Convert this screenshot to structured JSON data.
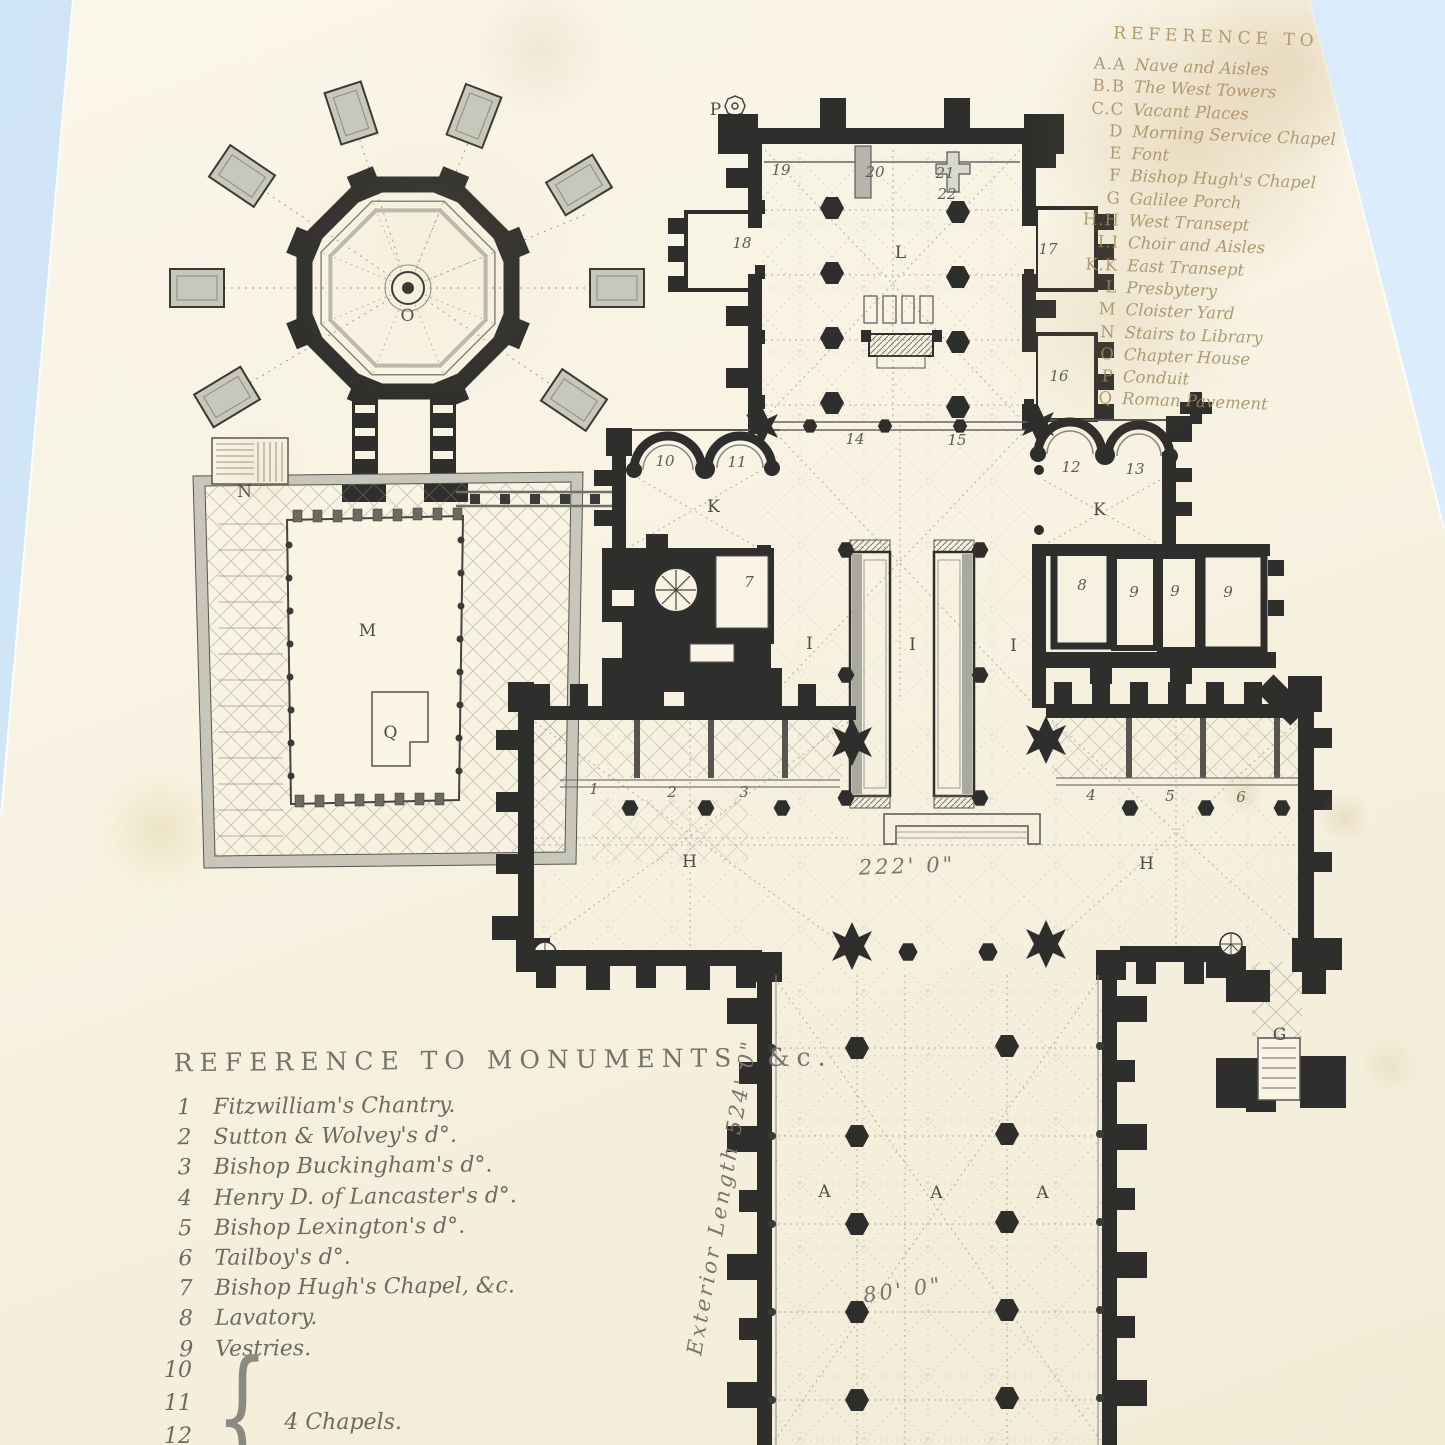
{
  "colors": {
    "background": "#d6e8f7",
    "page": "#f7f2e1",
    "ink": "#2e2e2c",
    "faded_ink": "#a18a63",
    "list_ink": "#6b6b62"
  },
  "plan_reference": {
    "title": "REFERENCE TO PLAN",
    "entries": [
      {
        "key": "A.A",
        "label": "Nave and Aisles"
      },
      {
        "key": "B.B",
        "label": "The West Towers"
      },
      {
        "key": "C.C",
        "label": "Vacant Places"
      },
      {
        "key": "D",
        "label": "Morning Service Chapel"
      },
      {
        "key": "E",
        "label": "Font"
      },
      {
        "key": "F",
        "label": "Bishop Hugh's Chapel"
      },
      {
        "key": "G",
        "label": "Galilee Porch"
      },
      {
        "key": "H.H",
        "label": "West Transept"
      },
      {
        "key": "I.I",
        "label": "Choir and Aisles"
      },
      {
        "key": "K.K",
        "label": "East Transept"
      },
      {
        "key": "L",
        "label": "Presbytery"
      },
      {
        "key": "M",
        "label": "Cloister Yard"
      },
      {
        "key": "N",
        "label": "Stairs to Library"
      },
      {
        "key": "O",
        "label": "Chapter House"
      },
      {
        "key": "P",
        "label": "Conduit"
      },
      {
        "key": "Q",
        "label": "Roman Pavement"
      }
    ]
  },
  "monuments_reference": {
    "title": "REFERENCE TO MONUMENTS, &c.",
    "entries": [
      {
        "num": "1",
        "label": "Fitzwilliam's Chantry."
      },
      {
        "num": "2",
        "label": "Sutton & Wolvey's d°."
      },
      {
        "num": "3",
        "label": "Bishop Buckingham's d°."
      },
      {
        "num": "4",
        "label": "Henry D. of Lancaster's d°."
      },
      {
        "num": "5",
        "label": "Bishop Lexington's d°."
      },
      {
        "num": "6",
        "label": "Tailboy's d°."
      },
      {
        "num": "7",
        "label": "Bishop Hugh's Chapel, &c."
      },
      {
        "num": "8",
        "label": "Lavatory."
      },
      {
        "num": "9",
        "label": "Vestries."
      }
    ],
    "group": {
      "nums": [
        "10",
        "11",
        "12"
      ],
      "brace_glyph": "{",
      "label": "4 Chapels."
    }
  },
  "plan_labels": [
    {
      "text": "O",
      "x": 408,
      "y": 316,
      "kind": "letter"
    },
    {
      "text": "N",
      "x": 245,
      "y": 492,
      "kind": "letter"
    },
    {
      "text": "M",
      "x": 368,
      "y": 631,
      "kind": "letter"
    },
    {
      "text": "Q",
      "x": 391,
      "y": 733,
      "kind": "letter"
    },
    {
      "text": "L",
      "x": 901,
      "y": 253,
      "kind": "letter"
    },
    {
      "text": "K",
      "x": 714,
      "y": 507,
      "kind": "letter"
    },
    {
      "text": "K",
      "x": 1100,
      "y": 510,
      "kind": "letter"
    },
    {
      "text": "I",
      "x": 810,
      "y": 644,
      "kind": "letter"
    },
    {
      "text": "I",
      "x": 913,
      "y": 645,
      "kind": "letter"
    },
    {
      "text": "I",
      "x": 1014,
      "y": 646,
      "kind": "letter"
    },
    {
      "text": "H",
      "x": 690,
      "y": 862,
      "kind": "letter"
    },
    {
      "text": "H",
      "x": 1147,
      "y": 864,
      "kind": "letter"
    },
    {
      "text": "A",
      "x": 825,
      "y": 1192,
      "kind": "letter"
    },
    {
      "text": "A",
      "x": 937,
      "y": 1193,
      "kind": "letter"
    },
    {
      "text": "A",
      "x": 1043,
      "y": 1193,
      "kind": "letter"
    },
    {
      "text": "G",
      "x": 1280,
      "y": 1035,
      "kind": "letter"
    },
    {
      "text": "P",
      "x": 716,
      "y": 110,
      "kind": "letter"
    },
    {
      "text": "1",
      "x": 594,
      "y": 789,
      "kind": "number"
    },
    {
      "text": "2",
      "x": 672,
      "y": 792,
      "kind": "number"
    },
    {
      "text": "3",
      "x": 744,
      "y": 792,
      "kind": "number"
    },
    {
      "text": "4",
      "x": 1091,
      "y": 795,
      "kind": "number"
    },
    {
      "text": "5",
      "x": 1170,
      "y": 796,
      "kind": "number"
    },
    {
      "text": "6",
      "x": 1241,
      "y": 797,
      "kind": "number"
    },
    {
      "text": "7",
      "x": 749,
      "y": 582,
      "kind": "number"
    },
    {
      "text": "8",
      "x": 1082,
      "y": 585,
      "kind": "number"
    },
    {
      "text": "9",
      "x": 1134,
      "y": 592,
      "kind": "number"
    },
    {
      "text": "9",
      "x": 1175,
      "y": 591,
      "kind": "number"
    },
    {
      "text": "9",
      "x": 1228,
      "y": 592,
      "kind": "number"
    },
    {
      "text": "10",
      "x": 665,
      "y": 461,
      "kind": "number"
    },
    {
      "text": "11",
      "x": 737,
      "y": 462,
      "kind": "number"
    },
    {
      "text": "12",
      "x": 1071,
      "y": 467,
      "kind": "number"
    },
    {
      "text": "13",
      "x": 1135,
      "y": 469,
      "kind": "number"
    },
    {
      "text": "14",
      "x": 855,
      "y": 439,
      "kind": "number"
    },
    {
      "text": "15",
      "x": 957,
      "y": 440,
      "kind": "number"
    },
    {
      "text": "16",
      "x": 1059,
      "y": 376,
      "kind": "number"
    },
    {
      "text": "17",
      "x": 1048,
      "y": 249,
      "kind": "number"
    },
    {
      "text": "18",
      "x": 742,
      "y": 243,
      "kind": "number"
    },
    {
      "text": "19",
      "x": 781,
      "y": 170,
      "kind": "number"
    },
    {
      "text": "20",
      "x": 875,
      "y": 172,
      "kind": "number"
    },
    {
      "text": "21",
      "x": 945,
      "y": 173,
      "kind": "number"
    },
    {
      "text": "22",
      "x": 947,
      "y": 194,
      "kind": "number"
    },
    {
      "text": "222' 0\"",
      "x": 907,
      "y": 866,
      "kind": "dim",
      "rotate": -2
    },
    {
      "text": "80' 0\"",
      "x": 903,
      "y": 1290,
      "kind": "dim",
      "rotate": -8
    },
    {
      "text": "Exterior Length 524' 0\"",
      "x": 722,
      "y": 1197,
      "kind": "dim",
      "rotate": -80
    }
  ]
}
